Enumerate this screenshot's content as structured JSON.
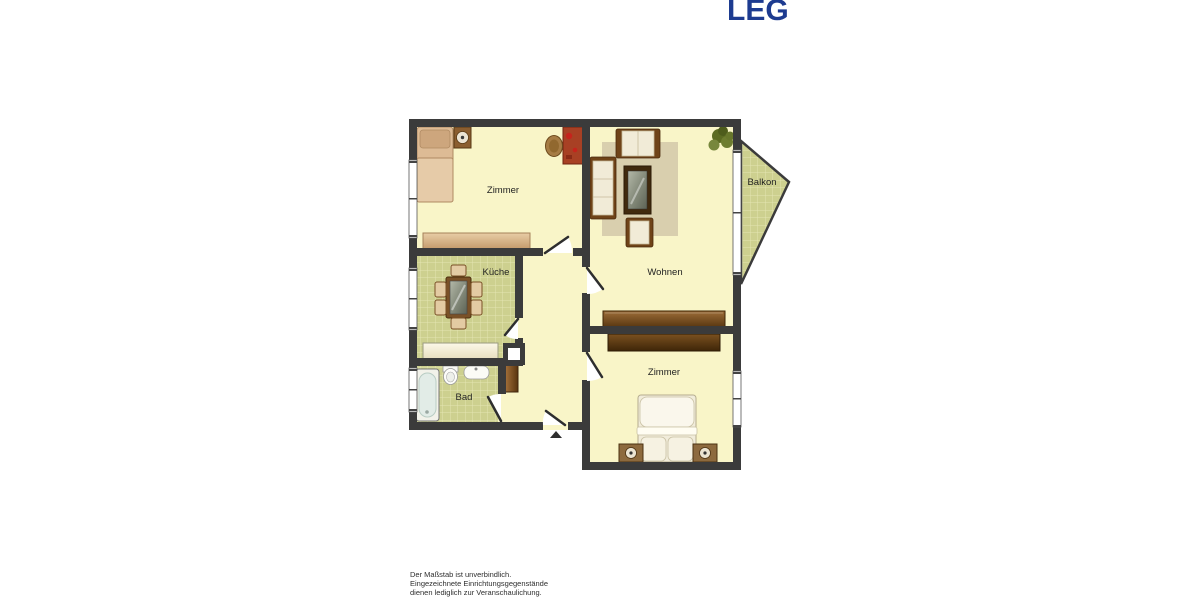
{
  "logo": {
    "text": "LEG"
  },
  "disclaimer": {
    "line1": "Der Maßstab ist unverbindlich.",
    "line2": "Eingezeichnete Einrichtungsgegenstände",
    "line3": "dienen lediglich zur Veranschaulichung."
  },
  "floorplan": {
    "rooms": [
      {
        "id": "zimmer-top",
        "label": "Zimmer",
        "furniture": [
          "single-bed",
          "nightstand",
          "desk",
          "desk-chair",
          "sideboard"
        ]
      },
      {
        "id": "kueche",
        "label": "Küche",
        "furniture": [
          "dining-table",
          "six-chairs",
          "kitchen-counter"
        ]
      },
      {
        "id": "wohnen",
        "label": "Wohnen",
        "furniture": [
          "sofa",
          "loveseat",
          "armchair",
          "coffee-table",
          "rug",
          "plant",
          "sideboard"
        ]
      },
      {
        "id": "zimmer-bottom",
        "label": "Zimmer",
        "furniture": [
          "double-bed",
          "nightstand-left",
          "nightstand-right",
          "wardrobe"
        ]
      },
      {
        "id": "bad",
        "label": "Bad",
        "furniture": [
          "bathtub",
          "toilet",
          "sink"
        ]
      },
      {
        "id": "balkon",
        "label": "Balkon",
        "furniture": []
      }
    ],
    "colors": {
      "wall": "#3B3B3B",
      "room_floor": "#F9F5C8",
      "tile_floor": "#CDD08F",
      "rug": "#D9CFAE",
      "logo_blue": "#1D3B90"
    }
  }
}
